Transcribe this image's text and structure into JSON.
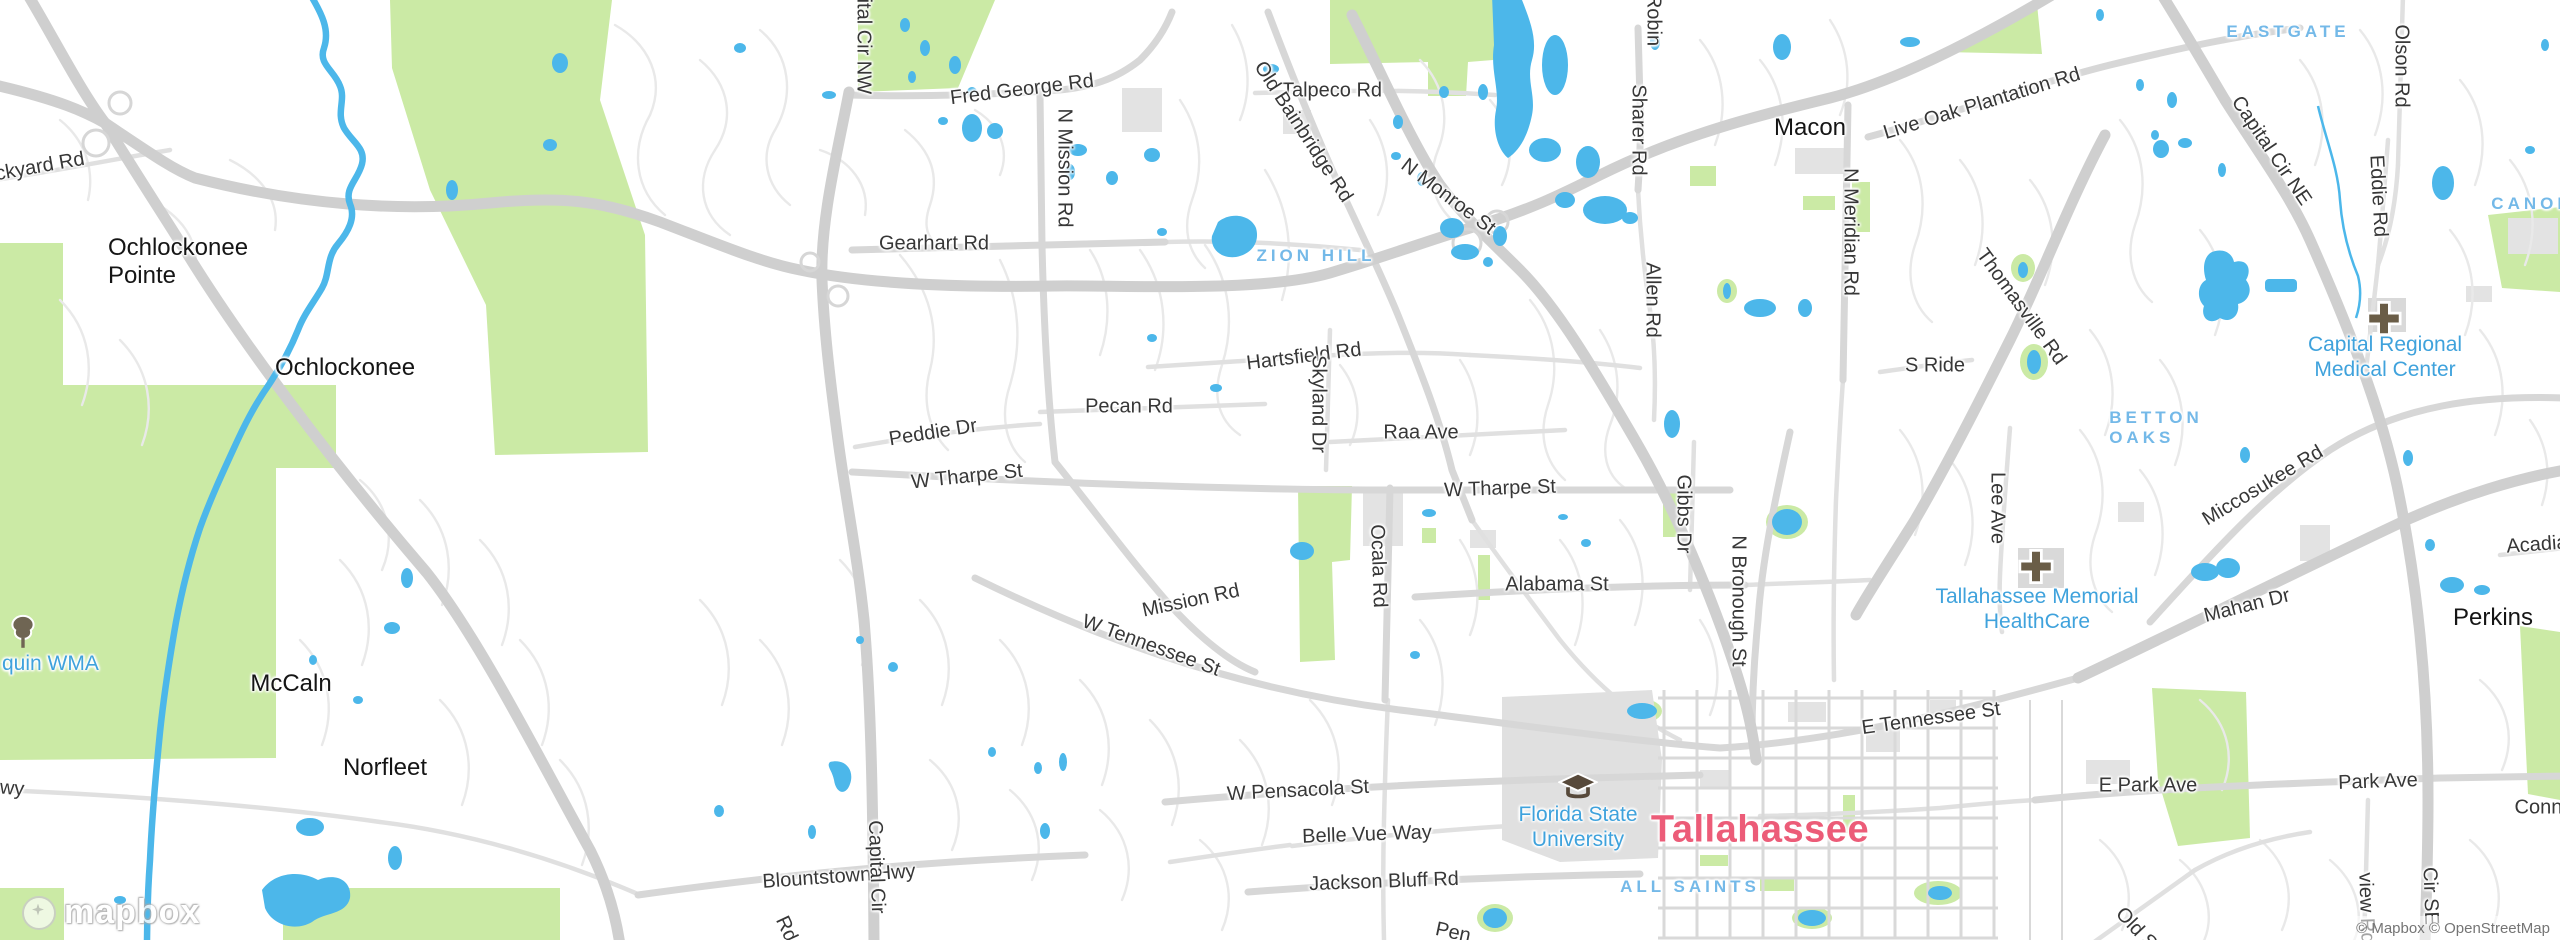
{
  "map": {
    "attribution": "© Mapbox © OpenStreetMap",
    "logo_text": "mapbox",
    "colors": {
      "water": "#4cb7ea",
      "park": "#cbeaa5",
      "road_major": "#cfcfcf",
      "road_minor": "#e9e9e9",
      "building": "#e3e3e3",
      "city_label": "#ec5c78",
      "neighborhood_label": "#74b9e8",
      "poi_label": "#3fa2dc",
      "road_label": "#373737"
    },
    "labels": [
      {
        "id": "ckyard-rd",
        "kind": "road",
        "text": "ckyard Rd",
        "x": 40,
        "y": 167,
        "rot": -10
      },
      {
        "id": "fred-george-rd",
        "kind": "road",
        "text": "Fred George Rd",
        "x": 1022,
        "y": 90,
        "rot": -7
      },
      {
        "id": "gearhart-rd",
        "kind": "road",
        "text": "Gearhart Rd",
        "x": 934,
        "y": 244,
        "rot": 0
      },
      {
        "id": "talpeco-rd",
        "kind": "road",
        "text": "Talpeco Rd",
        "x": 1332,
        "y": 91,
        "rot": 0
      },
      {
        "id": "old-bainbridge-rd",
        "kind": "road",
        "text": "Old Bainbridge Rd",
        "x": 1303,
        "y": 132,
        "rot": 57
      },
      {
        "id": "n-monroe-st",
        "kind": "road",
        "text": "N Monroe St",
        "x": 1448,
        "y": 197,
        "rot": 37
      },
      {
        "id": "n-mission-rd",
        "kind": "road",
        "text": "N Mission Rd",
        "x": 1064,
        "y": 168,
        "rot": 90
      },
      {
        "id": "mission-rd",
        "kind": "road",
        "text": "Mission Rd",
        "x": 1191,
        "y": 601,
        "rot": -12
      },
      {
        "id": "pecan-rd",
        "kind": "road",
        "text": "Pecan Rd",
        "x": 1129,
        "y": 407,
        "rot": 0
      },
      {
        "id": "peddie-dr",
        "kind": "road",
        "text": "Peddie Dr",
        "x": 933,
        "y": 433,
        "rot": -9
      },
      {
        "id": "w-tharpe-st-w",
        "kind": "road",
        "text": "W Tharpe St",
        "x": 967,
        "y": 477,
        "rot": -6
      },
      {
        "id": "w-tharpe-st-e",
        "kind": "road",
        "text": "W Tharpe St",
        "x": 1500,
        "y": 489,
        "rot": -2
      },
      {
        "id": "hartsfield-rd",
        "kind": "road",
        "text": "Hartsfield Rd",
        "x": 1304,
        "y": 357,
        "rot": -7
      },
      {
        "id": "skyland-dr",
        "kind": "road",
        "text": "Skyland Dr",
        "x": 1318,
        "y": 404,
        "rot": 90
      },
      {
        "id": "raa-ave",
        "kind": "road",
        "text": "Raa Ave",
        "x": 1421,
        "y": 433,
        "rot": 0
      },
      {
        "id": "ocala-rd",
        "kind": "road",
        "text": "Ocala Rd",
        "x": 1378,
        "y": 566,
        "rot": 88
      },
      {
        "id": "alabama-st",
        "kind": "road",
        "text": "Alabama St",
        "x": 1557,
        "y": 585,
        "rot": 0
      },
      {
        "id": "w-tennessee-st",
        "kind": "road",
        "text": "W Tennessee St",
        "x": 1151,
        "y": 646,
        "rot": 20
      },
      {
        "id": "sharer-rd",
        "kind": "road",
        "text": "Sharer Rd",
        "x": 1638,
        "y": 130,
        "rot": 90
      },
      {
        "id": "robin",
        "kind": "road",
        "text": "Robin",
        "x": 1653,
        "y": 20,
        "rot": 90
      },
      {
        "id": "allen-rd",
        "kind": "road",
        "text": "Allen Rd",
        "x": 1652,
        "y": 300,
        "rot": 90
      },
      {
        "id": "live-oak-plantation-rd",
        "kind": "road",
        "text": "Live Oak Plantation Rd",
        "x": 1982,
        "y": 104,
        "rot": -17
      },
      {
        "id": "n-meridian-rd",
        "kind": "road",
        "text": "N Meridian Rd",
        "x": 1850,
        "y": 232,
        "rot": 90
      },
      {
        "id": "thomasville-rd",
        "kind": "road",
        "text": "Thomasville Rd",
        "x": 2021,
        "y": 307,
        "rot": 54
      },
      {
        "id": "s-ride",
        "kind": "road",
        "text": "S Ride",
        "x": 1935,
        "y": 366,
        "rot": 0
      },
      {
        "id": "gibbs-dr",
        "kind": "road",
        "text": "Gibbs Dr",
        "x": 1683,
        "y": 514,
        "rot": 90
      },
      {
        "id": "n-bronough-st",
        "kind": "road",
        "text": "N Bronough St",
        "x": 1738,
        "y": 601,
        "rot": 90
      },
      {
        "id": "lee-ave",
        "kind": "road",
        "text": "Lee Ave",
        "x": 1997,
        "y": 508,
        "rot": 90
      },
      {
        "id": "miccosukee-rd",
        "kind": "road",
        "text": "Miccosukee Rd",
        "x": 2263,
        "y": 486,
        "rot": -31
      },
      {
        "id": "mahan-dr",
        "kind": "road",
        "text": "Mahan Dr",
        "x": 2247,
        "y": 606,
        "rot": -14
      },
      {
        "id": "acadia",
        "kind": "road",
        "text": "Acadia",
        "x": 2537,
        "y": 545,
        "rot": -4
      },
      {
        "id": "e-tennessee-st",
        "kind": "road",
        "text": "E Tennessee St",
        "x": 1931,
        "y": 719,
        "rot": -8
      },
      {
        "id": "e-park-ave",
        "kind": "road",
        "text": "E Park Ave",
        "x": 2148,
        "y": 786,
        "rot": 0
      },
      {
        "id": "park-ave",
        "kind": "road",
        "text": "Park Ave",
        "x": 2378,
        "y": 782,
        "rot": -2
      },
      {
        "id": "conne",
        "kind": "road",
        "text": "Conne",
        "x": 2544,
        "y": 808,
        "rot": 0
      },
      {
        "id": "w-pensacola-st",
        "kind": "road",
        "text": "W Pensacola St",
        "x": 1298,
        "y": 791,
        "rot": -3
      },
      {
        "id": "belle-vue-way",
        "kind": "road",
        "text": "Belle Vue Way",
        "x": 1367,
        "y": 835,
        "rot": -2
      },
      {
        "id": "jackson-bluff-rd",
        "kind": "road",
        "text": "Jackson Bluff Rd",
        "x": 1384,
        "y": 882,
        "rot": -2
      },
      {
        "id": "blountstown-hwy",
        "kind": "road",
        "text": "Blountstown Hwy",
        "x": 839,
        "y": 877,
        "rot": -4
      },
      {
        "id": "capital-cir-s",
        "kind": "road",
        "text": "Capital Cir",
        "x": 876,
        "y": 867,
        "rot": 88
      },
      {
        "id": "capital-cir-nw",
        "kind": "road",
        "text": "Capital Cir NW",
        "x": 863,
        "y": 28,
        "rot": 90
      },
      {
        "id": "olson-rd",
        "kind": "road",
        "text": "Olson Rd",
        "x": 2401,
        "y": 66,
        "rot": 90
      },
      {
        "id": "eddie-rd",
        "kind": "road",
        "text": "Eddie Rd",
        "x": 2378,
        "y": 196,
        "rot": 87
      },
      {
        "id": "capital-cir-ne",
        "kind": "road",
        "text": "Capital Cir NE",
        "x": 2271,
        "y": 151,
        "rot": 56
      },
      {
        "id": "old-s",
        "kind": "road",
        "text": "Old S",
        "x": 2136,
        "y": 929,
        "rot": 47
      },
      {
        "id": "view-rd",
        "kind": "road",
        "text": "view Rd",
        "x": 2366,
        "y": 908,
        "rot": 88
      },
      {
        "id": "cir-se",
        "kind": "road",
        "text": "Cir SE",
        "x": 2430,
        "y": 896,
        "rot": 88
      },
      {
        "id": "wy-frag",
        "kind": "road",
        "text": "wy",
        "x": 12,
        "y": 789,
        "rot": 5
      },
      {
        "id": "pen-frag",
        "kind": "road",
        "text": "Pen",
        "x": 1453,
        "y": 933,
        "rot": 12
      },
      {
        "id": "rd-frag",
        "kind": "road",
        "text": "Rd",
        "x": 786,
        "y": 929,
        "rot": 65
      },
      {
        "id": "ochlockonee-pointe",
        "kind": "town",
        "lines": [
          "Ochlockonee",
          "Pointe"
        ],
        "x": 178,
        "y": 262,
        "rot": 0
      },
      {
        "id": "ochlockonee",
        "kind": "town",
        "text": "Ochlockonee",
        "x": 345,
        "y": 368,
        "rot": 0
      },
      {
        "id": "mccaln",
        "kind": "town",
        "text": "McCaln",
        "x": 291,
        "y": 684,
        "rot": 0
      },
      {
        "id": "norfleet",
        "kind": "town",
        "text": "Norfleet",
        "x": 385,
        "y": 768,
        "rot": 0
      },
      {
        "id": "macon",
        "kind": "town",
        "text": "Macon",
        "x": 1810,
        "y": 128,
        "rot": 0
      },
      {
        "id": "perkins",
        "kind": "town",
        "text": "Perkins",
        "x": 2493,
        "y": 618,
        "rot": 0
      },
      {
        "id": "tallahassee",
        "kind": "city",
        "text": "Tallahassee",
        "x": 1760,
        "y": 830,
        "rot": 0
      },
      {
        "id": "zion-hill",
        "kind": "hood",
        "text": "ZION HILL",
        "x": 1316,
        "y": 256,
        "rot": 0
      },
      {
        "id": "eastgate",
        "kind": "hood",
        "text": "EASTGATE",
        "x": 2288,
        "y": 32,
        "rot": 0
      },
      {
        "id": "canop",
        "kind": "hood",
        "text": "CANOP",
        "x": 2532,
        "y": 204,
        "rot": 0
      },
      {
        "id": "betton-oaks",
        "kind": "hood",
        "lines": [
          "BETTON",
          "OAKS"
        ],
        "x": 2156,
        "y": 428,
        "rot": 0
      },
      {
        "id": "all-saints",
        "kind": "hood",
        "text": "ALL SAINTS",
        "x": 1690,
        "y": 887,
        "rot": 0
      },
      {
        "id": "quin-wma",
        "kind": "wma",
        "text": "quin WMA",
        "x": 2,
        "y": 664,
        "rot": 0,
        "anchor": "left"
      },
      {
        "id": "florida-state-university",
        "kind": "poi",
        "lines": [
          "Florida State",
          "University"
        ],
        "x": 1578,
        "y": 828,
        "rot": 0
      },
      {
        "id": "tallahassee-memorial-healthcare",
        "kind": "poi",
        "lines": [
          "Tallahassee Memorial",
          "HealthCare"
        ],
        "x": 2037,
        "y": 610,
        "rot": 0
      },
      {
        "id": "capital-regional-medical-center",
        "kind": "poi",
        "lines": [
          "Capital Regional",
          "Medical Center"
        ],
        "x": 2385,
        "y": 358,
        "rot": 0
      }
    ],
    "icons": [
      {
        "name": "tree-icon",
        "x": 23,
        "y": 634
      },
      {
        "name": "graduation-cap-icon",
        "x": 1578,
        "y": 789
      },
      {
        "name": "hospital-cross-icon",
        "x": 2036,
        "y": 569
      },
      {
        "name": "hospital-cross-icon",
        "x": 2384,
        "y": 321
      }
    ]
  }
}
